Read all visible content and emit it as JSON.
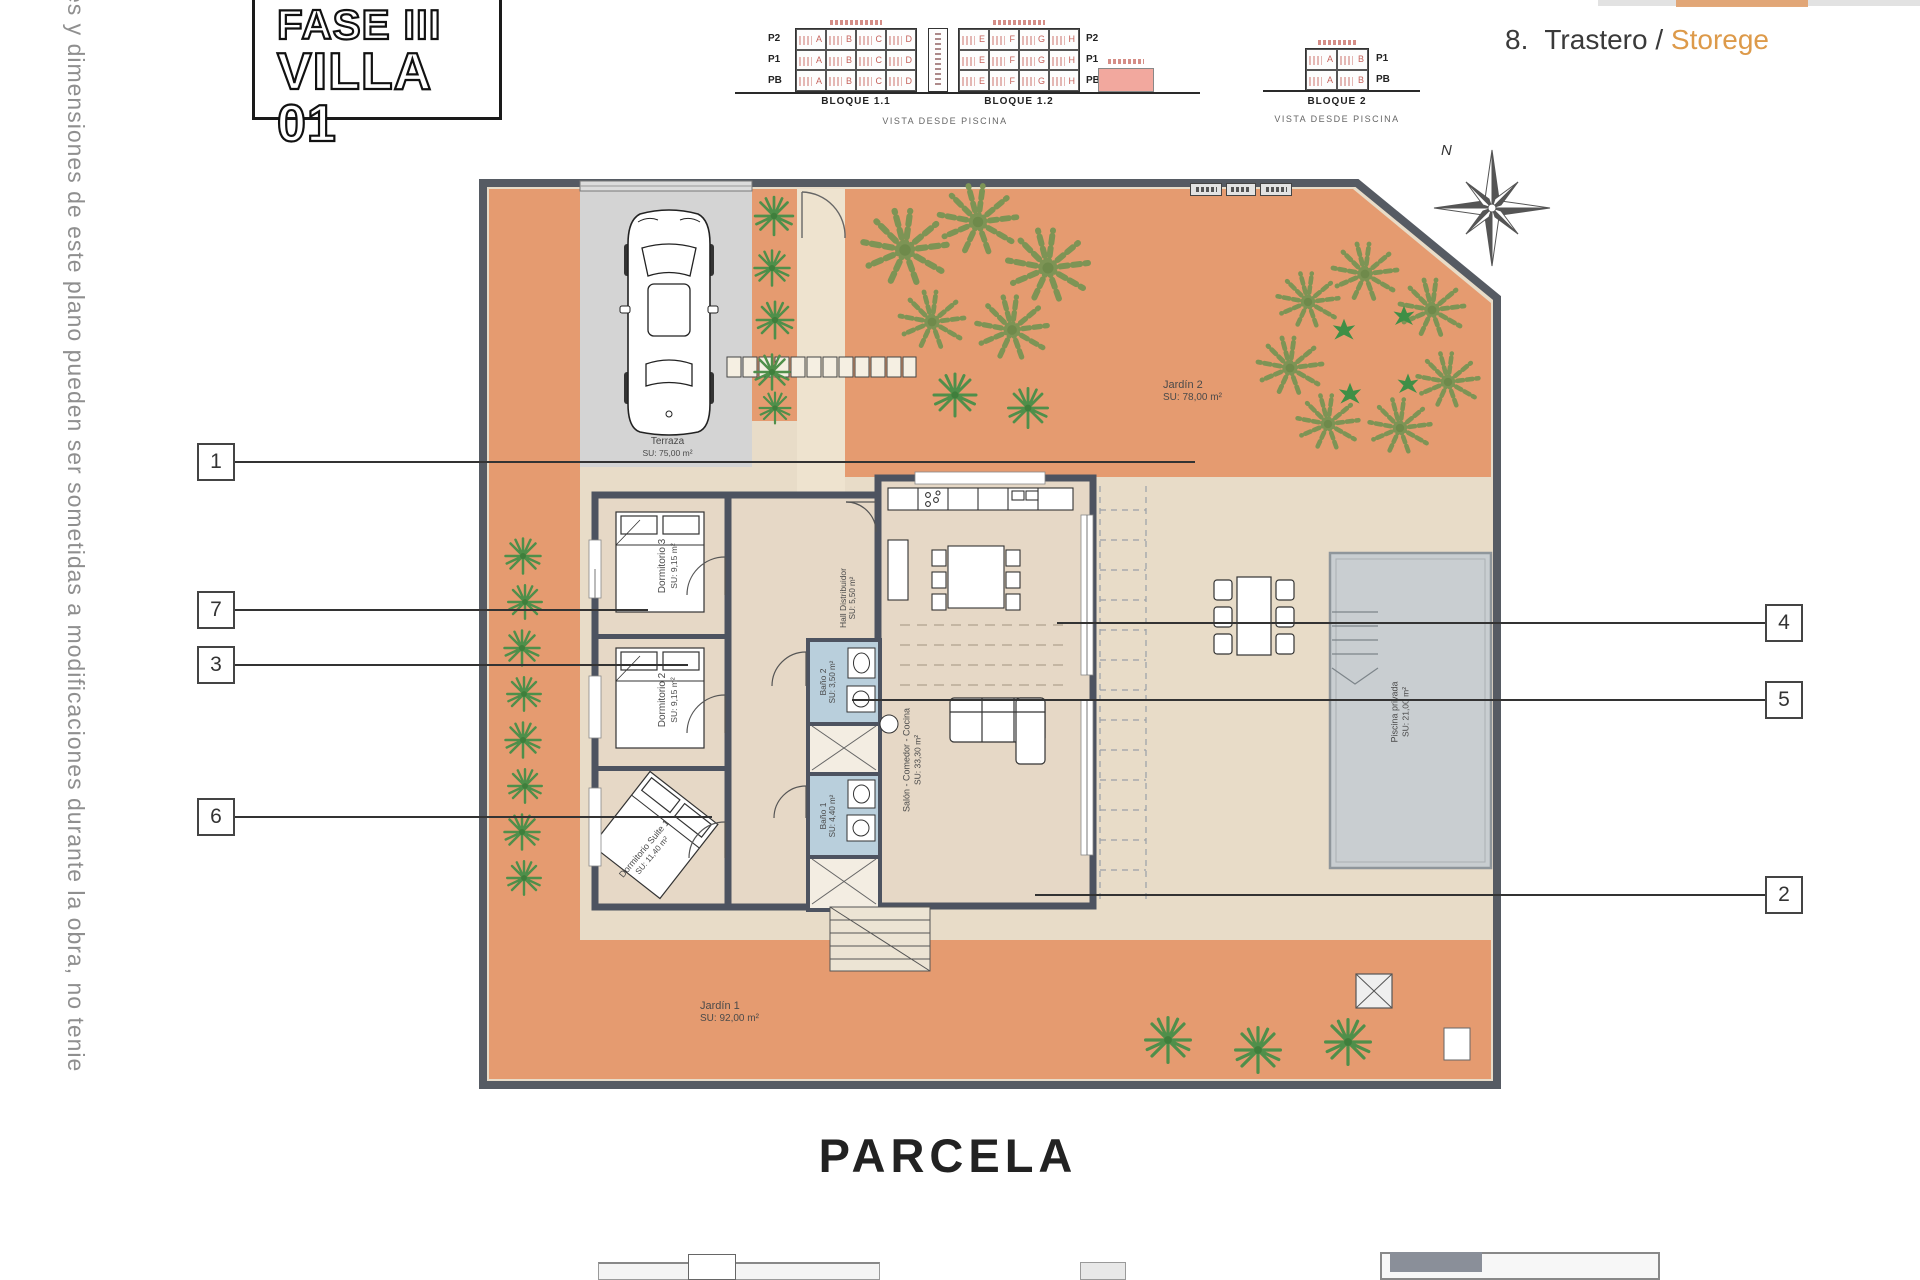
{
  "side_note": "es y dimensiones de este plano pueden ser sometidas a modificaciones durante la obra, no tenie",
  "title": {
    "line1": "FASE III",
    "line2": "VILLA 01"
  },
  "legend_item": {
    "number": "8.",
    "name": "Trastero",
    "sep": " / ",
    "alt": "Storege"
  },
  "elevations": {
    "caption": "VISTA DESDE PISCINA",
    "bloque11": {
      "label": "BLOQUE 1.1",
      "rows": [
        "P2",
        "P1",
        "PB"
      ],
      "units": [
        "A",
        "B",
        "C",
        "D"
      ]
    },
    "bloque12": {
      "label": "BLOQUE 1.2",
      "rows": [
        "P2",
        "P1",
        "PB"
      ],
      "units": [
        "E",
        "F",
        "G",
        "H"
      ]
    },
    "bloque2": {
      "label": "BLOQUE 2",
      "caption": "VISTA DESDE PISCINA",
      "rows": [
        "P1",
        "PB"
      ],
      "units": [
        "A",
        "B"
      ]
    }
  },
  "plan": {
    "north_label": "N",
    "parcel_label": "PARCELA",
    "rooms": {
      "terraza": {
        "name": "Terraza",
        "area": "SU: 75,00 m²"
      },
      "jardin2": {
        "name": "Jardín 2",
        "area": "SU: 78,00 m²"
      },
      "jardin1": {
        "name": "Jardín 1",
        "area": "SU: 92,00 m²"
      },
      "dorm3": {
        "name": "Dormitorio 3",
        "area": "SU: 9,15 m²"
      },
      "dorm2": {
        "name": "Dormitorio 2",
        "area": "SU: 9,15 m²"
      },
      "suite": {
        "name": "Dormitorio Suite 1",
        "area": "SU: 11,40 m²"
      },
      "bano2": {
        "name": "Baño 2",
        "area": "SU: 3,50 m²"
      },
      "bano1": {
        "name": "Baño 1",
        "area": "SU: 4,40 m²"
      },
      "hall": {
        "name": "Hall Distribuidor",
        "area": "SU: 5,50 m²"
      },
      "salon": {
        "name": "Salón - Comedor - Cocina",
        "area": "SU: 33,30 m²"
      },
      "piscina": {
        "name": "Piscina privada",
        "area": "SU: 21,00 m²"
      }
    },
    "callouts": {
      "c1": "1",
      "c7": "7",
      "c3": "3",
      "c6": "6",
      "c4": "4",
      "c5": "5",
      "c2": "2"
    }
  },
  "colors": {
    "garden_orange": "#e59b70",
    "terrace_beige": "#e8dcc8",
    "wall_dark": "#4d5360",
    "bath_blue": "#b9cfdc",
    "pool_gray": "#c9ced1",
    "legend_accent_orange": "#dd9a4a",
    "unit_letter_red": "#c4625c",
    "highlight_pink": "#f2a89e"
  }
}
